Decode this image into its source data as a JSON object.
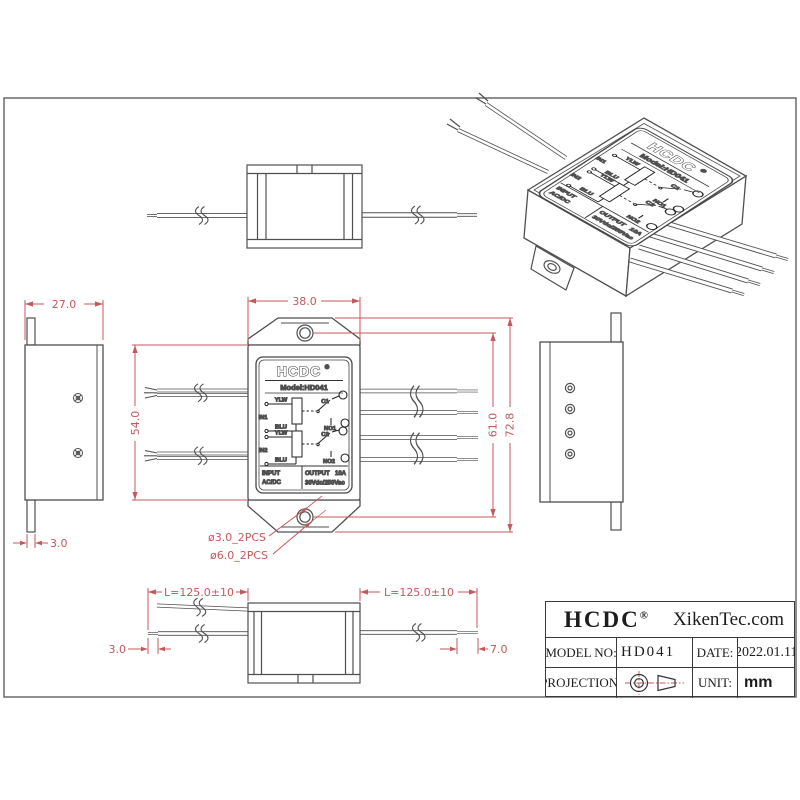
{
  "drawing": {
    "dims": {
      "top_width": "38.0",
      "body_height": "54.0",
      "hole_pitch": "61.0",
      "overall_height": "72.8",
      "side_width": "27.0",
      "side_tab": "3.0",
      "hole_small": "ø3.0_2PCS",
      "hole_large": "ø6.0_2PCS",
      "wire_len_left": "L=125.0±10",
      "wire_len_right": "L=125.0±10",
      "tip_left": "3.0",
      "tip_right": "7.0"
    },
    "label": {
      "brand": "HCDC",
      "reg": "®",
      "model": "Model:HD041",
      "relay1": {
        "input": "IN1",
        "lead_top": "YLW",
        "lead_bottom": "BLU",
        "common": "C1",
        "no": "NO1"
      },
      "relay2": {
        "input": "IN2",
        "lead_top": "YLW",
        "lead_bottom": "BLU",
        "common": "C2",
        "no": "NO2"
      },
      "input_title": "INPUT",
      "input_value": "AC/DC",
      "output_title": "OUTPUT",
      "output_current": "10A",
      "output_rating": "30Vdc/250Vac"
    }
  },
  "title_block": {
    "brand": "HCDC",
    "reg": "®",
    "website": "XikenTec.com",
    "model_label": "MODEL NO:",
    "model_value": "HD041",
    "date_label": "DATE:",
    "date_value": "2022.01.11",
    "projection_label": "PROJECTION:",
    "unit_label": "UNIT:",
    "unit_value": "mm"
  },
  "colors": {
    "line": "#4f4f4f",
    "dim_red": "#c4595c",
    "ink": "#1c1c1c"
  }
}
